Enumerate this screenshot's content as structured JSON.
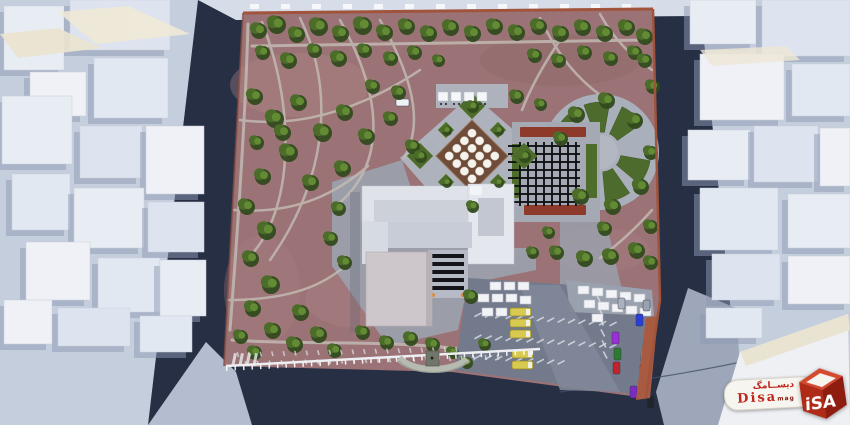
{
  "watermark": {
    "arabic": "دیســامگ",
    "latin": "Disa",
    "suffix": "mag",
    "logo_letters": "iSA"
  },
  "palette": {
    "park_path": "#9b7376",
    "tree_green": "#4a6a28",
    "plaza_gray": "#aab0bb",
    "asphalt_dark": "#272f45",
    "street_light": "#c5cedd",
    "context_building": "#e8ecf3",
    "red_wall": "#a0543c",
    "flowerbed_red": "#8d3a2a",
    "bus_yellow": "#d8ca4f",
    "logo_red": "#c0271c"
  }
}
